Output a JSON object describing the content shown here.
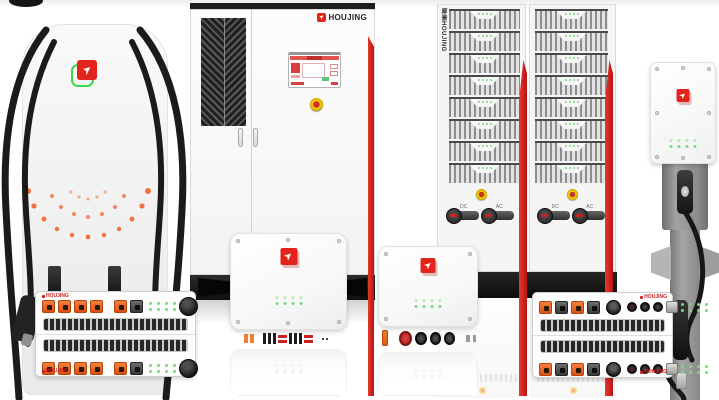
{
  "brand": {
    "name": "HOUJING",
    "vertical_label": "厚景HOUJING",
    "module_mark": "HOUJING",
    "logo_glyph": "➤"
  },
  "rack": {
    "switch_labels": [
      "DC",
      "AC"
    ]
  },
  "colors": {
    "background": "#ffffff",
    "accent_red": "#c92020",
    "logo_red": "#e3241d",
    "logo_green_outline": "#3ed648",
    "connector_orange": "#e8581a",
    "led_green": "#7bd97b",
    "estop_yellow": "#f2c400",
    "estop_red": "#cc2222",
    "cable_black": "#1b1b1b",
    "grille_dark": "#2f2f2f",
    "pedestal_gray": "#9a9a9a",
    "body_gray": "#f2f2f2"
  }
}
